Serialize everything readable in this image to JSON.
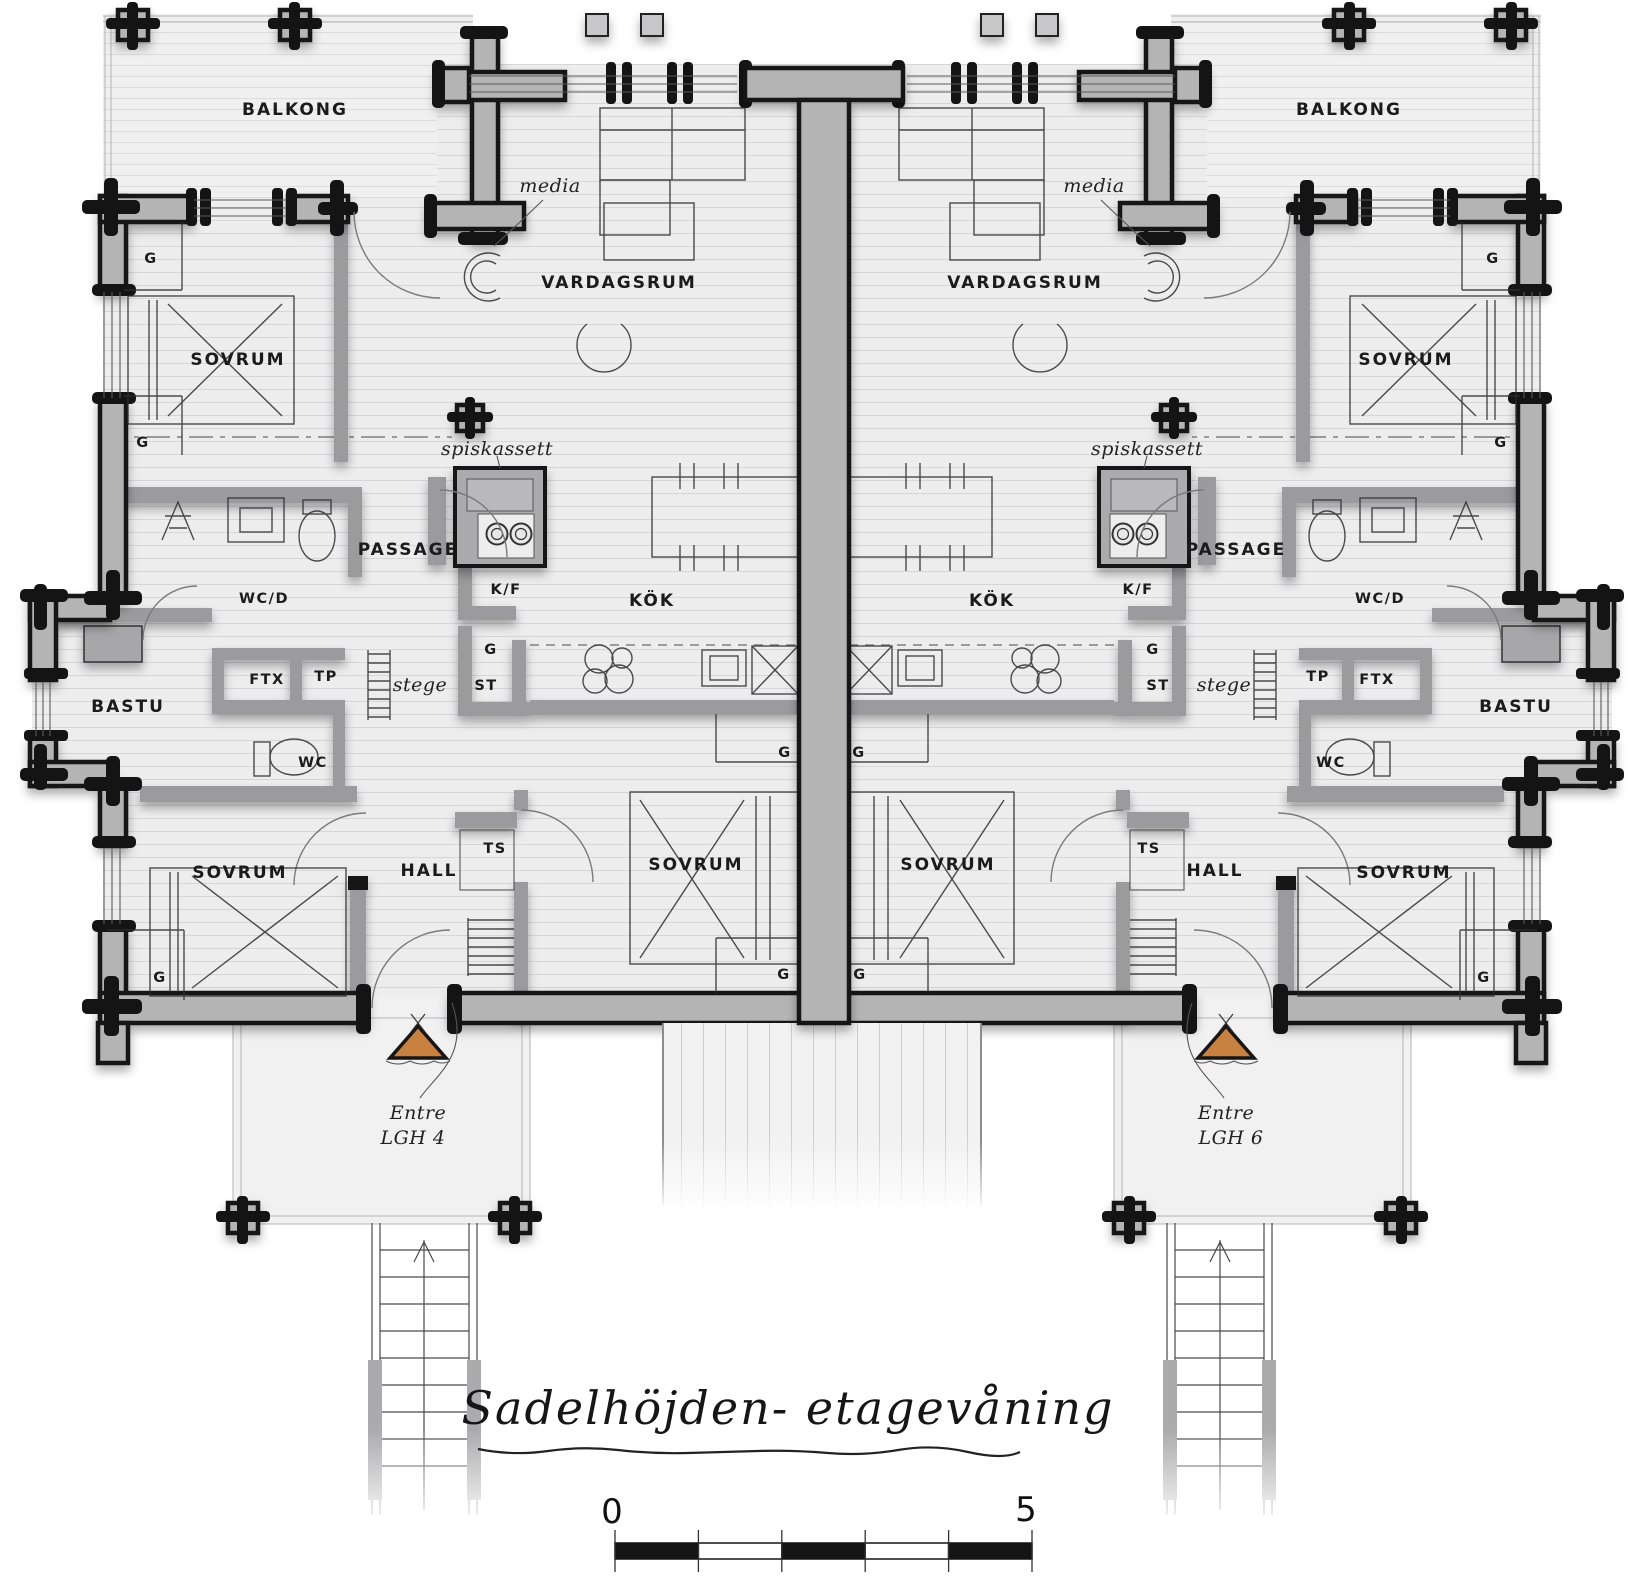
{
  "drawing_title": "Sadelhöjden- etagevåning",
  "scale_bar": {
    "start_label": "0",
    "end_label": "5"
  },
  "rooms": {
    "balkong": "BALKONG",
    "vardagsrum": "VARDAGSRUM",
    "media": "media",
    "sovrum": "SOVRUM",
    "spiskassett": "spiskassett",
    "passage": "PASSAGE",
    "wc_d": "WC/D",
    "k_f": "K/F",
    "kok": "KÖK",
    "g": "G",
    "st": "ST",
    "ts": "TS",
    "tp": "TP",
    "ftx": "FTX",
    "stege": "stege",
    "bastu": "BASTU",
    "wc": "WC",
    "hall": "HALL",
    "entre": "Entre",
    "lgh4": "LGH 4",
    "lgh6": "LGH 6"
  },
  "colors": {
    "entrance_marker": "#c8813f",
    "wall_fill": "#b4b4b4",
    "partition_fill": "#9b9b9d",
    "floor_fill": "#ededee"
  }
}
